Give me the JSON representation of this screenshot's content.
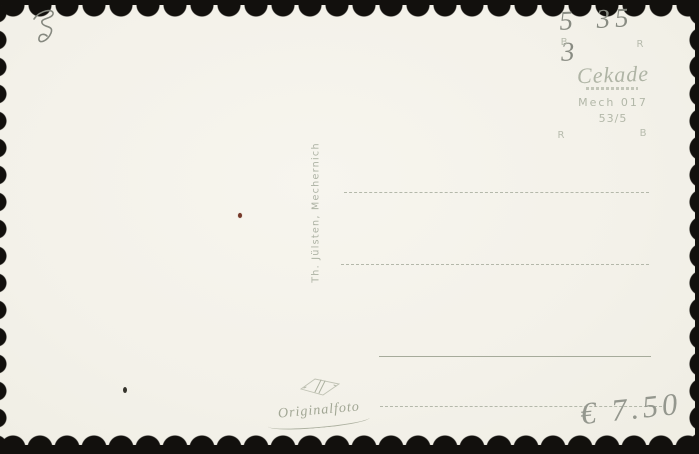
{
  "scan": {
    "description": "Back side of a blank vintage photo postcard with scalloped deckle edges on a dark scanner background"
  },
  "colors": {
    "scan_background": "#12100d",
    "paper": "#f4f2ea",
    "printed_ink": "#b2b7a8",
    "pencil": "#85887f",
    "speck_red": "#76392a",
    "speck_dark": "#35332b"
  },
  "handwriting": {
    "top_left_mark": "pencil squiggle",
    "catalog_number": "5 35 3",
    "price": "€ 7.50"
  },
  "stamp_box": {
    "corner_marks": {
      "top_left": "B",
      "top_right": "R",
      "bottom_left": "R",
      "bottom_right": "B"
    },
    "logo": "Cekade",
    "publisher_code": "Mech 017",
    "series_number": "53/5"
  },
  "publisher_credit": "Th. Jülsten, Mechernich",
  "footer": {
    "original_photo_label": "Originalfoto",
    "printer_mark": "diamond monogram"
  }
}
